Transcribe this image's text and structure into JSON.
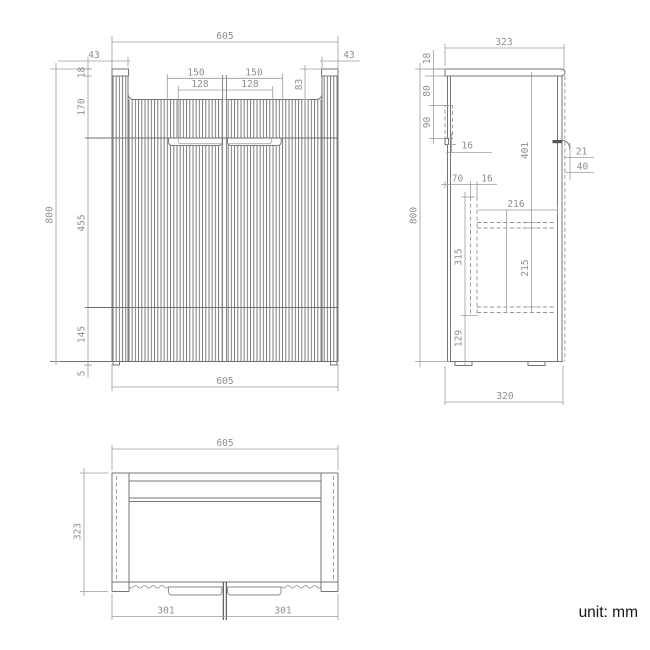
{
  "note": {
    "unit_label": "unit: mm"
  },
  "front_view": {
    "width_top": "605",
    "side_panel_left": "43",
    "side_panel_right": "43",
    "handle_span_left": "150",
    "handle_span_right": "150",
    "handle_inner_left": "128",
    "handle_inner_right": "128",
    "recess_depth": "83",
    "top_thickness": "18",
    "upper_section_height": "170",
    "door_height": "455",
    "drawer_height": "145",
    "foot_height": "5",
    "total_height": "800",
    "width_bottom": "605"
  },
  "side_view": {
    "depth_top": "323",
    "top_thickness": "18",
    "bracket_offset": "80",
    "bracket_height": "90",
    "bracket_lip": "16",
    "back_clearance": "70",
    "panel_thickness": "16",
    "upper_inner_height": "401",
    "handle_depth": "21",
    "handle_height": "40",
    "internal_depth": "216",
    "drawer_box_height": "315",
    "shelf_clearance": "215",
    "bottom_clearance": "129",
    "total_height": "800",
    "depth_bottom": "320"
  },
  "top_view": {
    "width": "605",
    "depth": "323",
    "door_width_left": "301",
    "door_width_right": "301"
  }
}
